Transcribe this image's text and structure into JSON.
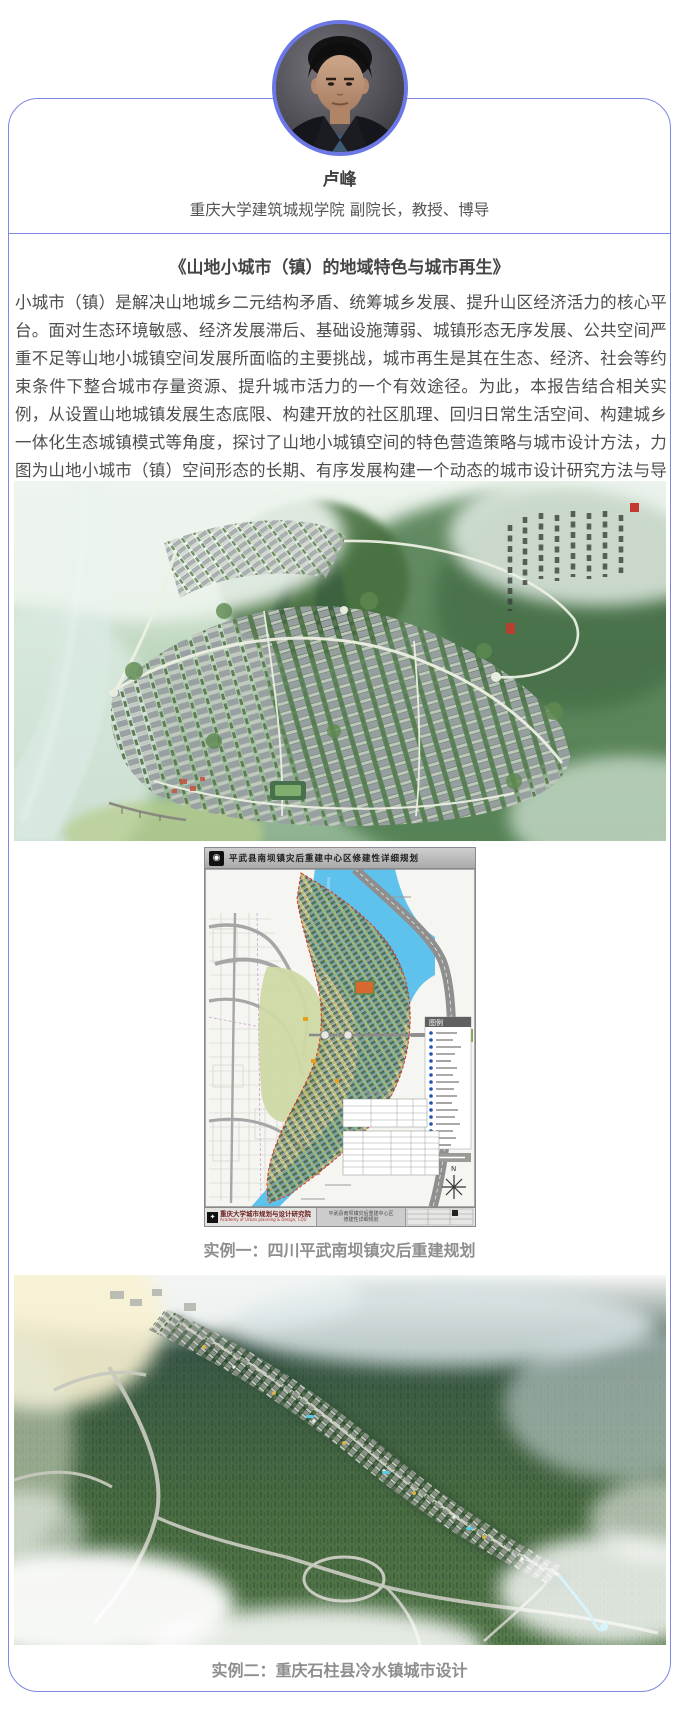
{
  "profile": {
    "name": "卢峰",
    "title": "重庆大学建筑城规学院 副院长，教授、博导"
  },
  "article": {
    "title": "《山地小城市（镇）的地域特色与城市再生》",
    "body": "小城市（镇）是解决山地城乡二元结构矛盾、统筹城乡发展、提升山区经济活力的核心平台。面对生态环境敏感、经济发展滞后、基础设施薄弱、城镇形态无序发展、公共空间严重不足等山地小城镇空间发展所面临的主要挑战，城市再生是其在生态、经济、社会等约束条件下整合城市存量资源、提升城市活力的一个有效途径。为此，本报告结合相关实例，从设置山地城镇发展生态底限、构建开放的社区肌理、回归日常生活空间、构建城乡一体化生态城镇模式等角度，探讨了山地小城镇空间的特色营造策略与城市设计方法，力图为山地小城市（镇）空间形态的长期、有序发展构建一个动态的城市设计研究方法与导控机制。"
  },
  "captions": {
    "example1": "实例一：四川平武南坝镇灾后重建规划",
    "example2": "实例二：重庆石柱县冷水镇城市设计"
  },
  "map": {
    "header_title": "平武县南坝镇灾后重建中心区修建性详细规划",
    "legend_title": "图例",
    "north_label": "N",
    "footer": {
      "institute": "重庆大学城市规划与设计研究院",
      "institute_en": "Academy of Urban planning & Design, CQU",
      "project_line1": "平武县南坝镇灾后重建中心区",
      "project_line2": "修建性详细规划"
    }
  },
  "colors": {
    "accent_border": "#7e87e4",
    "avatar_ring": "#6c77e6",
    "body_text": "#4d4d4d",
    "caption_text": "#8e8e8e",
    "river_blue": "#5ec2ec",
    "site_boundary_red": "#e03020"
  }
}
